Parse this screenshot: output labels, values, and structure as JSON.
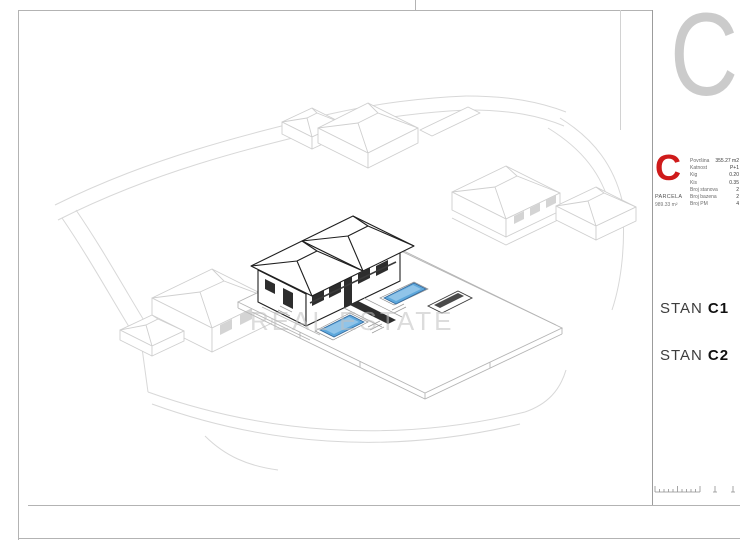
{
  "sheet": {
    "background": "#ffffff",
    "frame_color": "#b3b3b3",
    "corner_letter": "C",
    "corner_letter_color": "#cbcbcb"
  },
  "title_block": {
    "logo_letter": "C",
    "logo_color": "#cf1b1b",
    "parcel_label": "PARCELA",
    "parcel_value": "989.33 m²",
    "stats": [
      {
        "label": "Površina",
        "value": "355.27 m2"
      },
      {
        "label": "Katnost",
        "value": "P+1"
      },
      {
        "label": "Kig",
        "value": "0.20"
      },
      {
        "label": "Kis",
        "value": "0.35"
      },
      {
        "label": "Broj stanova",
        "value": "2"
      },
      {
        "label": "Broj bazena",
        "value": "2"
      },
      {
        "label": "Broj PM",
        "value": "4"
      }
    ],
    "units": [
      {
        "prefix": "STAN",
        "id": "C1"
      },
      {
        "prefix": "STAN",
        "id": "C2"
      }
    ]
  },
  "drawing": {
    "watermark": "REAL ESTATE",
    "pool_fill": "#5ea8dc",
    "pool_stroke": "#34699c",
    "pool_light": "#9ccbec"
  }
}
